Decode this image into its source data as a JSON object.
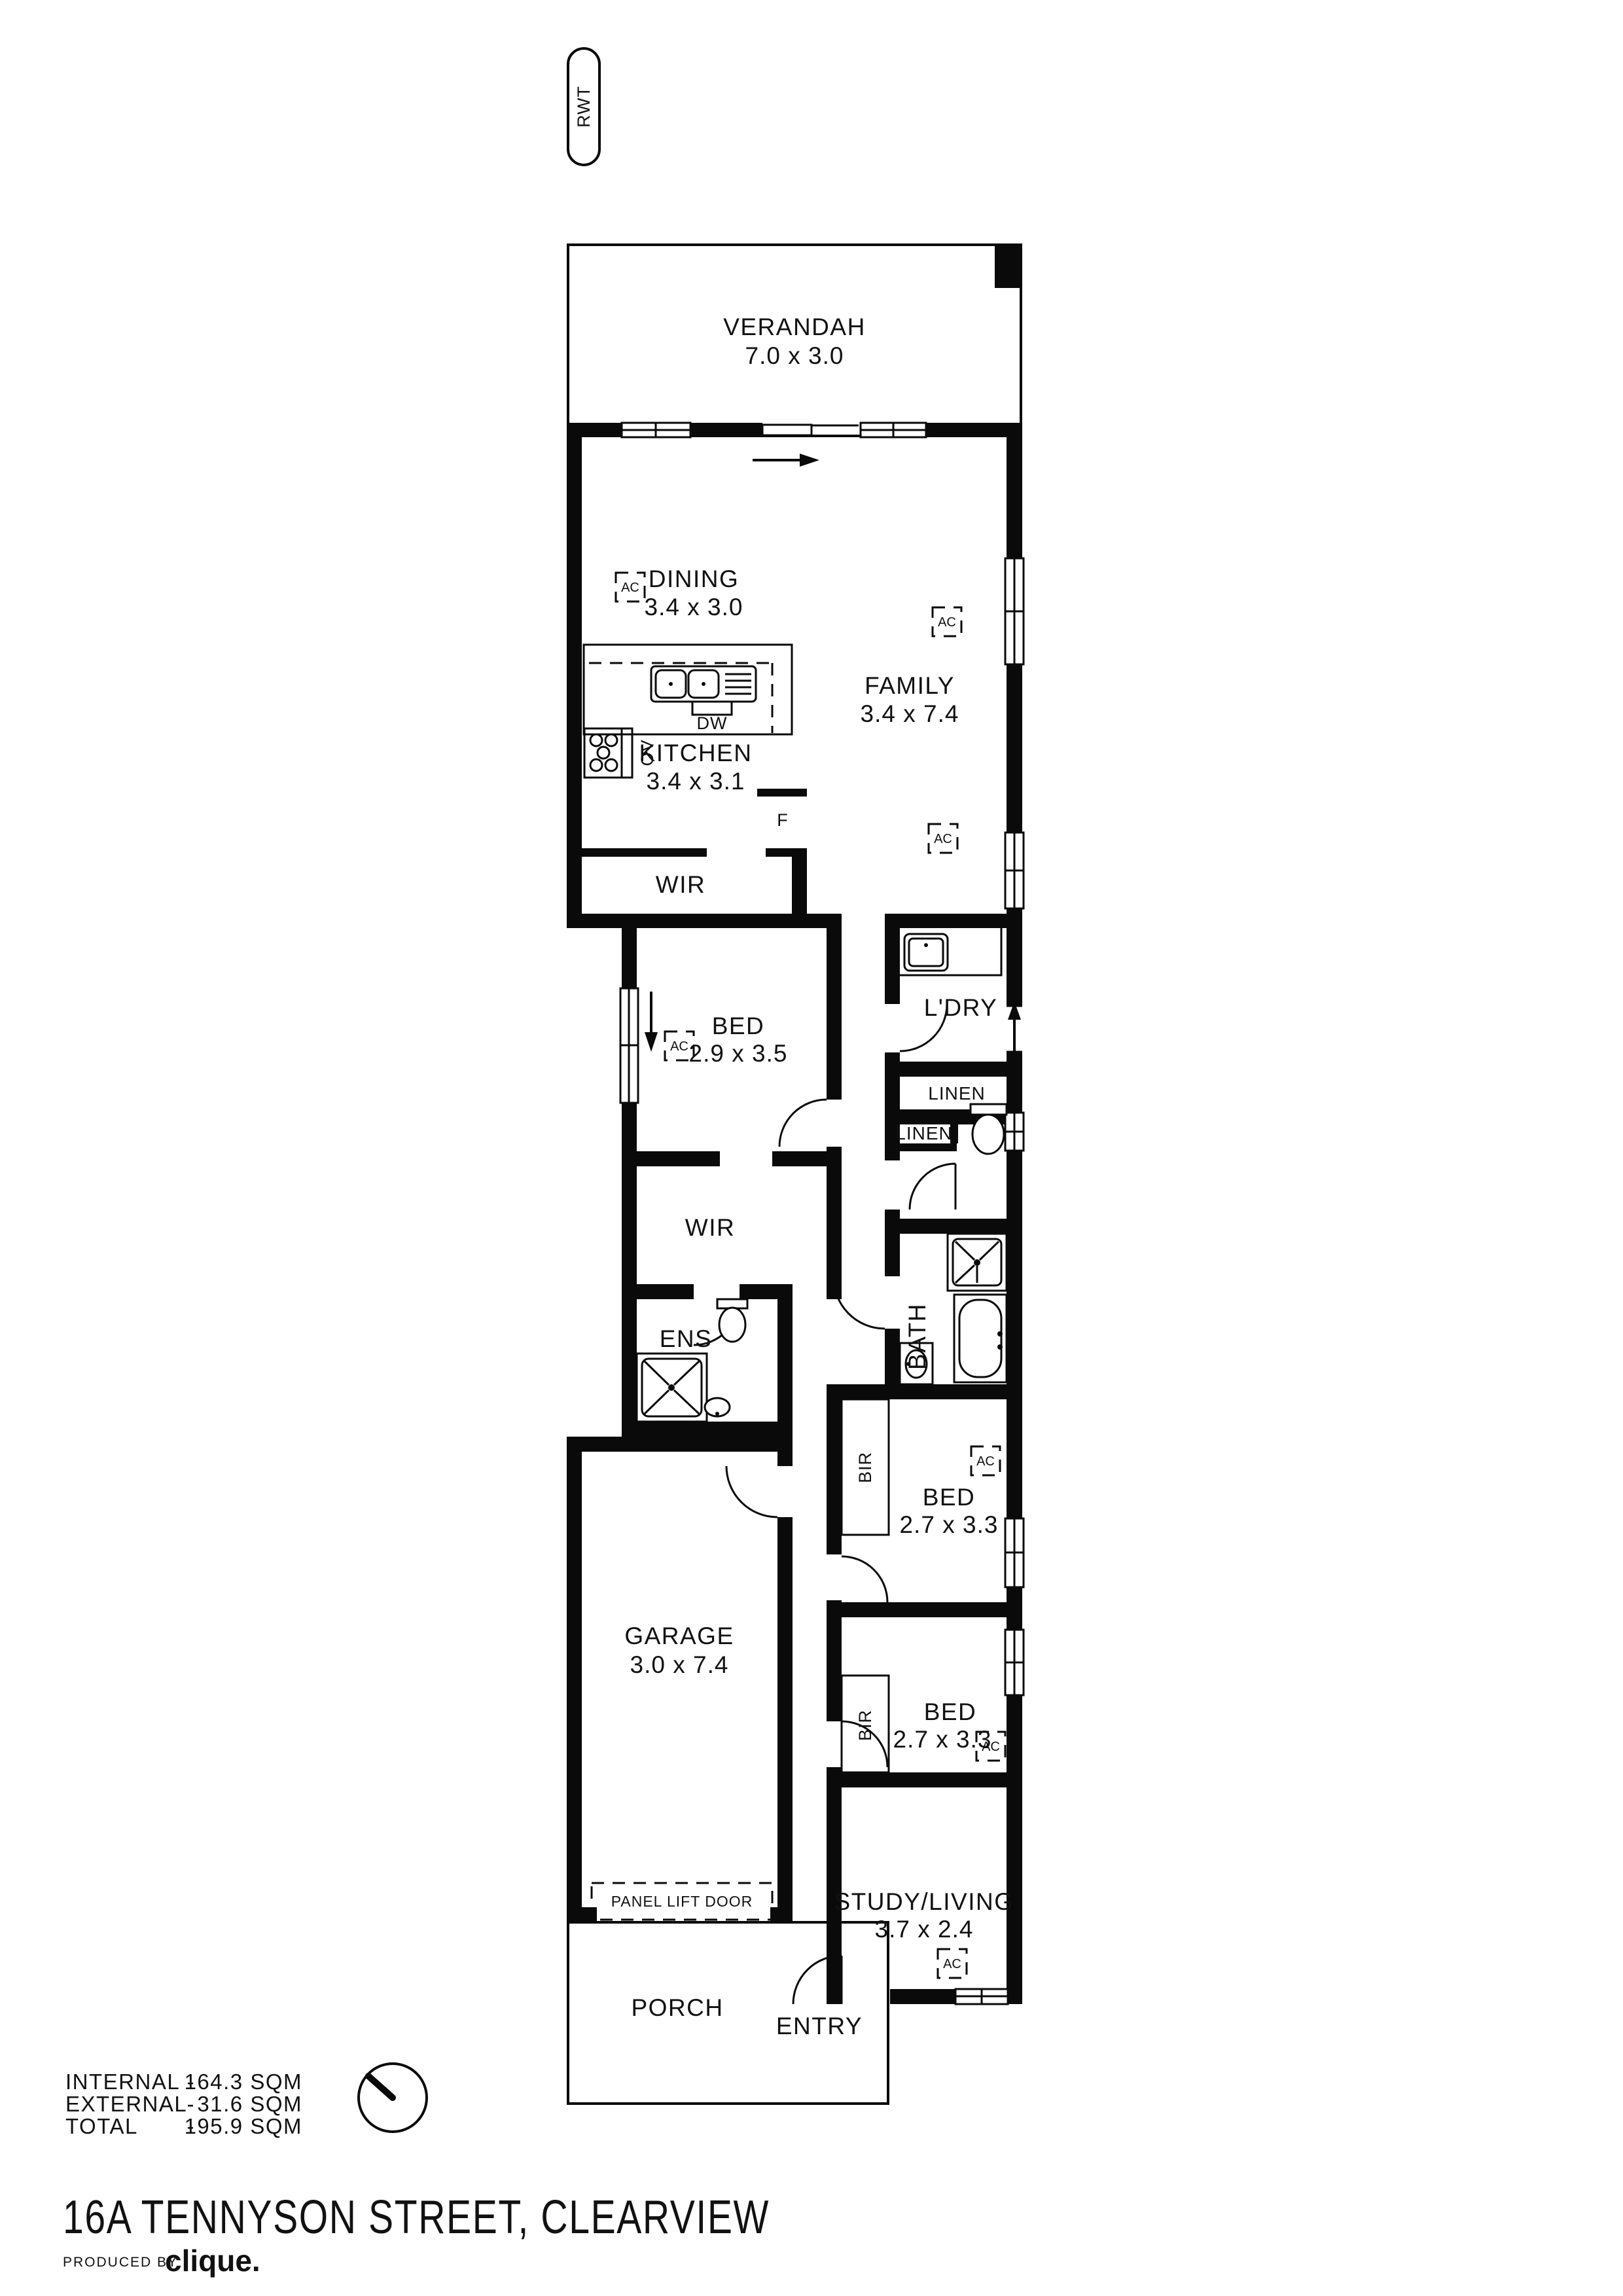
{
  "plan": {
    "tank_label": "RWT",
    "ac_label": "AC",
    "rooms": {
      "verandah": {
        "name": "VERANDAH",
        "dims": "7.0 x 3.0"
      },
      "dining": {
        "name": "DINING",
        "dims": "3.4 x 3.0"
      },
      "family": {
        "name": "FAMILY",
        "dims": "3.4 x 7.4"
      },
      "kitchen": {
        "name": "KITCHEN",
        "dims": "3.4 x 3.1"
      },
      "wir_kitchen": {
        "name": "WIR"
      },
      "bed_main": {
        "name": "BED",
        "dims": "2.9 x 3.5"
      },
      "wir_main": {
        "name": "WIR"
      },
      "ens": {
        "name": "ENS"
      },
      "laundry": {
        "name": "L'DRY"
      },
      "linen_hall": {
        "name": "LINEN"
      },
      "linen_wc": {
        "name": "LINEN"
      },
      "bath": {
        "name": "BATH"
      },
      "bed_2": {
        "name": "BED",
        "dims": "2.7 x 3.3"
      },
      "bed_3": {
        "name": "BED",
        "dims": "2.7 x 3.3"
      },
      "garage": {
        "name": "GARAGE",
        "dims": "3.0 x 7.4"
      },
      "study": {
        "name": "STUDY/LIVING",
        "dims": "3.7 x 2.4"
      },
      "porch": {
        "name": "PORCH"
      },
      "entry": {
        "name": "ENTRY"
      }
    },
    "fixtures": {
      "dishwasher": "DW",
      "oven": "OV",
      "fridge": "F",
      "robe": "BIR",
      "garage_door": "PANEL LIFT DOOR"
    }
  },
  "summary": {
    "internal": {
      "label": "INTERNAL",
      "sep": "-",
      "value": "164.3 SQM"
    },
    "external": {
      "label": "EXTERNAL",
      "sep": "-",
      "value": "31.6 SQM"
    },
    "total": {
      "label": "TOTAL",
      "sep": "-",
      "value": "195.9 SQM"
    }
  },
  "title": "16A TENNYSON STREET, CLEARVIEW",
  "footer": {
    "produced_by": "PRODUCED BY",
    "brand": "clique."
  }
}
